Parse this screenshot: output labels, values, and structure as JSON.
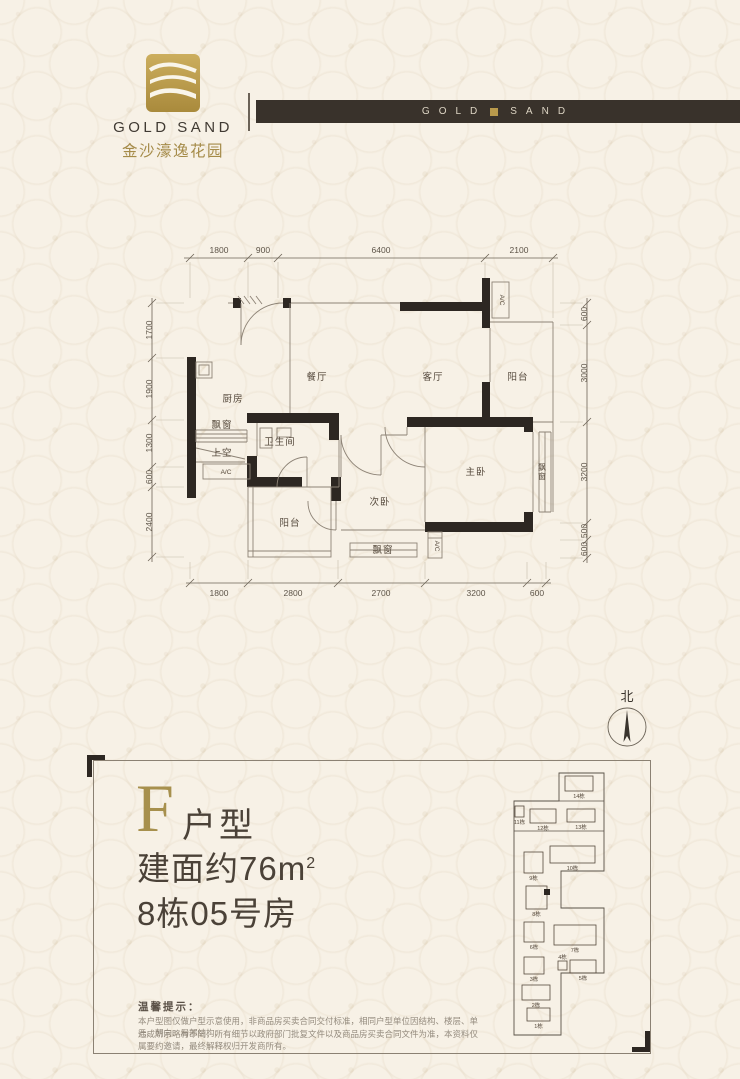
{
  "header": {
    "logo": {
      "name_en": "GOLD SAND",
      "name_cn": "金沙濠逸花园"
    },
    "banner": {
      "word_gold": "GOLD",
      "word_sand": "SAND"
    }
  },
  "floorplan": {
    "dims": {
      "top": [
        "1800",
        "900",
        "6400",
        "2100"
      ],
      "bottom": [
        "1800",
        "2800",
        "2700",
        "3200",
        "600"
      ],
      "left": [
        "1700",
        "1900",
        "1300",
        "600",
        "2400"
      ],
      "right": [
        "600",
        "3000",
        "3200",
        "500",
        "600"
      ]
    },
    "rooms": {
      "dining": "餐厅",
      "living": "客厅",
      "balcony_top": "阳台",
      "kitchen": "厨房",
      "bay_left": "飘窗",
      "void": "上空",
      "bath": "卫生间",
      "balcony_bottom": "阳台",
      "bed2": "次卧",
      "master": "主卧",
      "bay_bottom": "飘窗",
      "bay_right": "飘窗"
    },
    "ac_label": "A/C",
    "north_label": "北"
  },
  "unit_info": {
    "letter": "F",
    "type_label": "户型",
    "area_prefix": "建面约",
    "area_value": "76",
    "area_unit": "m",
    "area_sup": "2",
    "room_line": "8栋05号房"
  },
  "tips": {
    "title": "温馨提示：",
    "line1": "本户型图仅做户型示意使用，非商品房买卖合同交付标准，相同户型单位因结构、楼层、单元、朝向、局部结构、",
    "line2": "造成所示略有不同，所有细节以政府部门批复文件以及商品房买卖合同文件为准，本资料仅属要约邀请，最终解释权归开发商所有。"
  },
  "site_plan": {
    "buildings": [
      {
        "label": "14栋",
        "x": 83,
        "y": 8,
        "w": 28,
        "h": 15
      },
      {
        "label": "11栋",
        "x": 33,
        "y": 38,
        "w": 9,
        "h": 11
      },
      {
        "label": "12栋",
        "x": 48,
        "y": 41,
        "w": 26,
        "h": 14
      },
      {
        "label": "13栋",
        "x": 85,
        "y": 41,
        "w": 28,
        "h": 13
      },
      {
        "label": "9栋",
        "x": 42,
        "y": 84,
        "w": 19,
        "h": 21
      },
      {
        "label": "10栋",
        "x": 68,
        "y": 78,
        "w": 45,
        "h": 17
      },
      {
        "label": "8栋",
        "x": 44,
        "y": 118,
        "w": 21,
        "h": 23,
        "hl": true
      },
      {
        "label": "6栋",
        "x": 42,
        "y": 154,
        "w": 20,
        "h": 20
      },
      {
        "label": "7栋",
        "x": 72,
        "y": 157,
        "w": 42,
        "h": 20
      },
      {
        "label": "3栋",
        "x": 42,
        "y": 189,
        "w": 20,
        "h": 17
      },
      {
        "label": "4栋",
        "x": 76,
        "y": 193,
        "w": 9,
        "h": 9,
        "above": true
      },
      {
        "label": "5栋",
        "x": 88,
        "y": 192,
        "w": 26,
        "h": 13
      },
      {
        "label": "2栋",
        "x": 40,
        "y": 217,
        "w": 28,
        "h": 15
      },
      {
        "label": "1栋",
        "x": 45,
        "y": 240,
        "w": 23,
        "h": 13
      }
    ]
  }
}
